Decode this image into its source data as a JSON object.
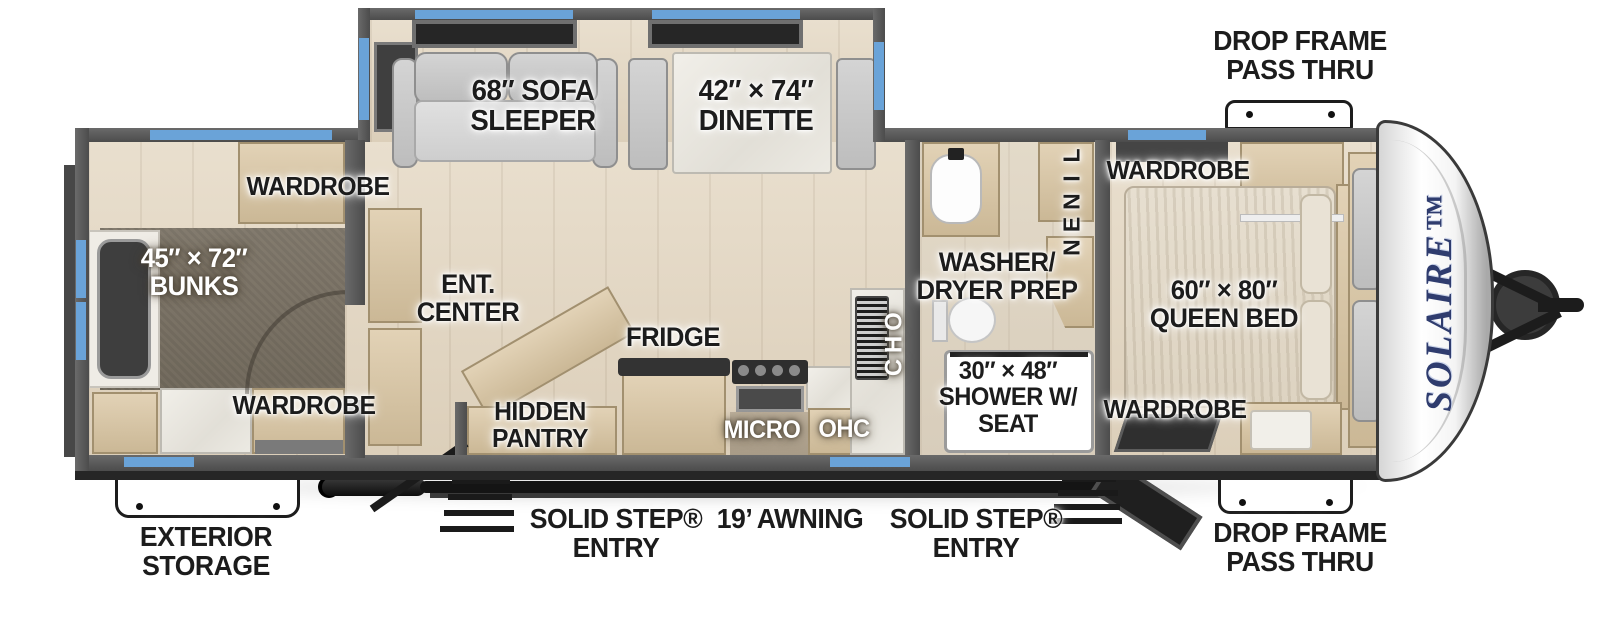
{
  "title": "SolAire Travel Trailer Floor Plan",
  "colors": {
    "accent_blue": "#6aa3d8",
    "wall_gray": "#5d5d5d",
    "brand_navy": "#2f3c6e",
    "floor_wood": "#e2d7c5",
    "carpet": "#7e766a"
  },
  "brand": {
    "logo": "SOLAIRE™"
  },
  "labels": {
    "dropframe_top": "DROP FRAME\nPASS THRU",
    "sofa": "68″ SOFA\nSLEEPER",
    "dinette": "42″ × 74″\nDINETTE",
    "wardrobe_bunk_top": "WARDROBE",
    "bunks": "45″ × 72″\nBUNKS",
    "wardrobe_bunk_bottom": "WARDROBE",
    "ent_center": "ENT.\nCENTER",
    "fridge": "FRIDGE",
    "hidden_pantry": "HIDDEN\nPANTRY",
    "micro": "MICRO",
    "ohc": "OHC",
    "ohc_vertical": "OHC",
    "linen": "LINEN",
    "washer_dryer": "WASHER/\nDRYER PREP",
    "wardrobe_bed_top": "WARDROBE",
    "queen_bed": "60″ × 80″\nQUEEN BED",
    "shower": "30″ × 48″\nSHOWER W/\nSEAT",
    "wardrobe_bed_bottom": "WARDROBE",
    "exterior_storage": "EXTERIOR\nSTORAGE",
    "solid_step_left": "SOLID STEP®\nENTRY",
    "awning": "19’ AWNING",
    "solid_step_right": "SOLID STEP®\nENTRY",
    "dropframe_bottom": "DROP FRAME\nPASS THRU"
  }
}
